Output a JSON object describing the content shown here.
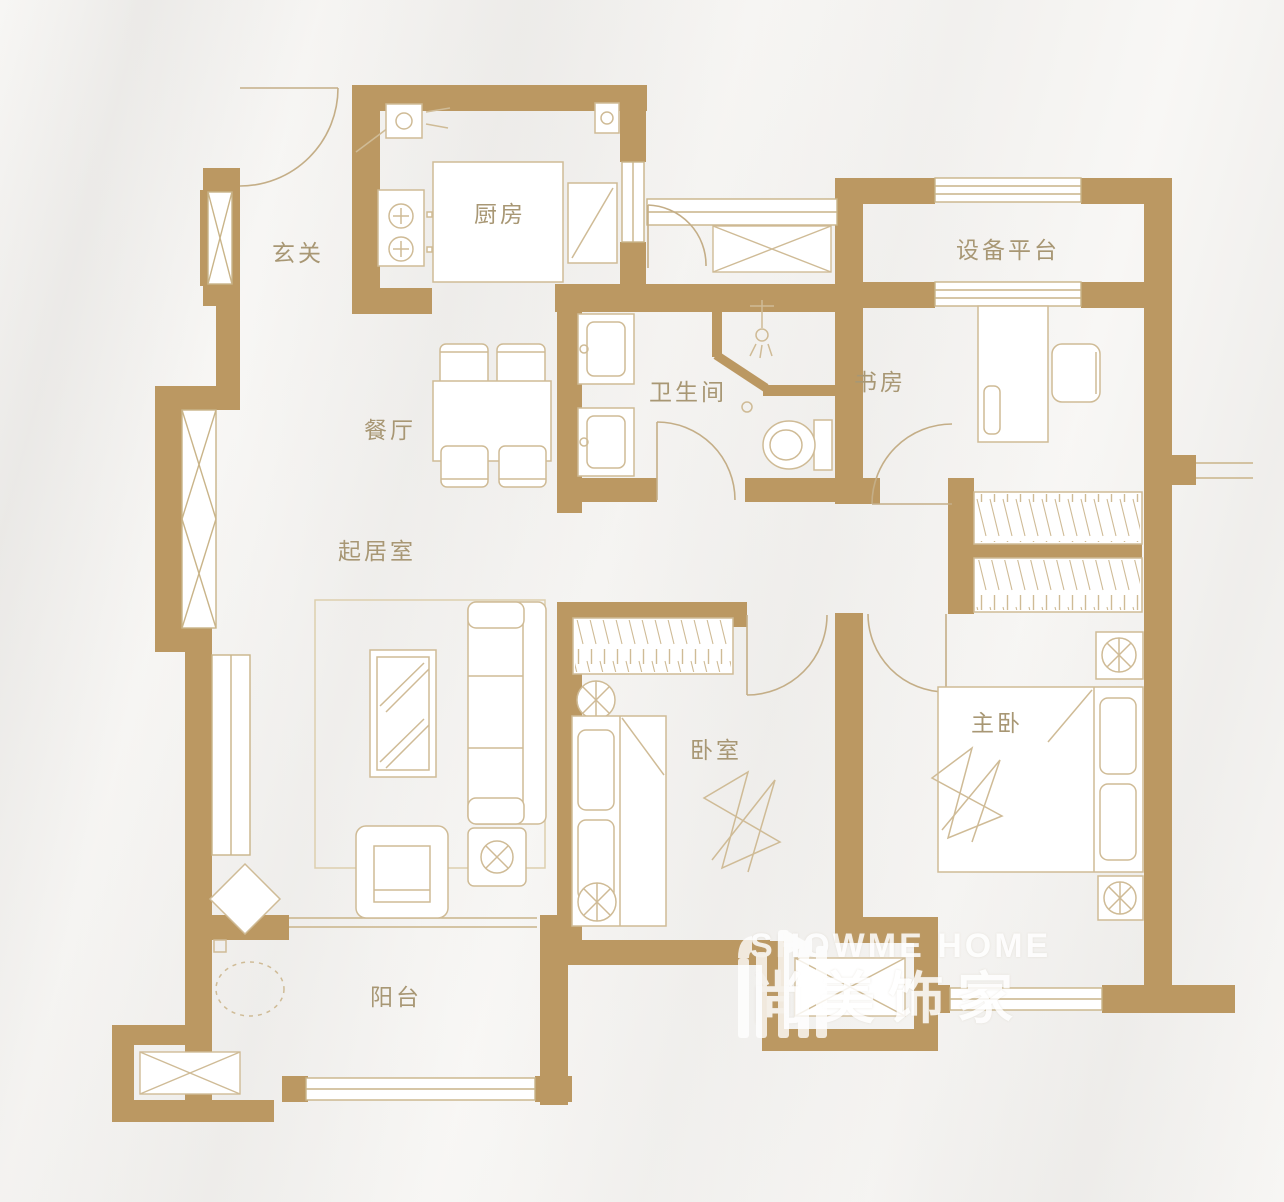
{
  "rooms": {
    "entry": {
      "label": "玄关"
    },
    "kitchen": {
      "label": "厨房"
    },
    "equipment_platform": {
      "label": "设备平台"
    },
    "bathroom": {
      "label": "卫生间"
    },
    "study": {
      "label": "书房"
    },
    "dining": {
      "label": "餐厅"
    },
    "living": {
      "label": "起居室"
    },
    "bedroom": {
      "label": "卧室"
    },
    "master_bedroom": {
      "label": "主卧"
    },
    "balcony": {
      "label": "阳台"
    }
  },
  "watermark": {
    "brand_en": "SHOWME HOME",
    "brand_cn": "尚美饰家"
  },
  "colors": {
    "wall": "#bb9862",
    "window_line": "#c9b489",
    "furniture_line": "#cfbb96",
    "door_arc": "#c4ae87",
    "label_text": "#a89774",
    "watermark_text": "#ffffff"
  }
}
